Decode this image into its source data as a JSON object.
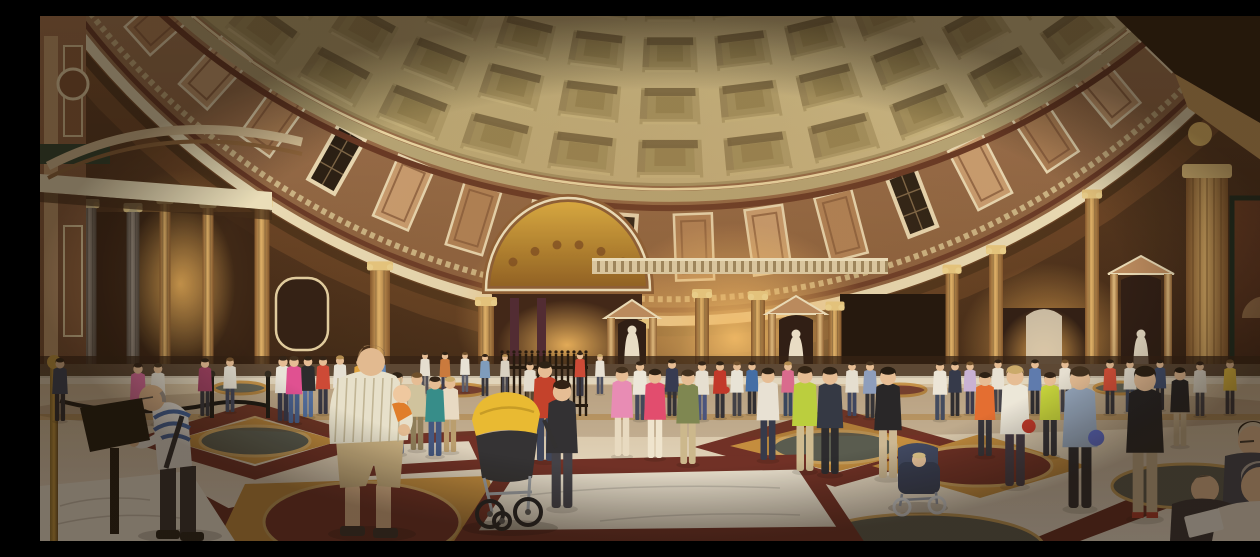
{
  "meta": {
    "title": "Panoramic photograph of the Pantheon interior, Rome",
    "alt": "Wide panoramic photo inside the Pantheon: coffered concrete dome above a curved marble attic and cornice, golden lit chapels, Corinthian columns and statue niches, with crowds of tourists on the patterned marble floor of circles and squares."
  },
  "palette": {
    "wallTop": "#7a4c2a",
    "wallBottom": "#311b0d",
    "dome1": "#a3925e",
    "dome2": "#c8b788",
    "cofferBase": "#a89767",
    "cofferIn1": "#9c8b5b",
    "cofferIn2": "#8f7e4e",
    "cofferShadow": "#695939",
    "cofferHi": "#d9c994",
    "domeRing": "#b3a476",
    "domeRingRed": "#5c2d1e",
    "domeRingHi": "#ead9a8",
    "attic1": "#c79c70",
    "attic2": "#7c5236",
    "panelMarble1": "#c59a70",
    "panelMarble2": "#aa7c54",
    "panelFrame": "#e9dbb8",
    "panelDark": "#19120c",
    "corniceWhite": "#eadfbc",
    "corniceRed": "#5e2f20",
    "corniceShadow": "#33200f",
    "dentil": "#c9b386",
    "colGold1": "#7e5128",
    "colGold2": "#dcae66",
    "colGray1": "#494039",
    "colGray2": "#92877d",
    "aedFace": "#b8875c",
    "statue": "#e9dec9",
    "nicheDark": "#271710",
    "balustrade": "#d9c6a0",
    "baluster": "#8a7048",
    "floorFar": "#cdb795",
    "floorNear": "#efe8da",
    "ochre": "#c28b3c",
    "pRed": "#6b2a22",
    "pRedDark": "#5f241c",
    "slate": "#53574d",
    "marbleWhite": "#e8e0d0",
    "skin": "#e6bd96",
    "shadow": "#2a160a",
    "fence": "#1d120a",
    "rope": "#14110e",
    "brass": "#c79a3e"
  },
  "dome": {
    "cx": 630,
    "cy": -480,
    "rx": 700,
    "ry": 650,
    "sRows": [
      1.0,
      0.918,
      0.838,
      0.76,
      0.684
    ],
    "thetaMax": 56,
    "cols": 15
  },
  "attic": {
    "cx": 630,
    "cy": -470,
    "rx": 760,
    "ry": 775,
    "thetaMax": 60,
    "step": 6.2,
    "pattern": [
      "m1",
      "w",
      "m2",
      "m1",
      "m2",
      "w",
      "m1",
      "m2"
    ]
  },
  "glows": [
    [
      140,
      268,
      85,
      115,
      "#f0b35a",
      0.7
    ],
    [
      530,
      302,
      115,
      95,
      "#f5b95e",
      0.75
    ],
    [
      695,
      322,
      140,
      115,
      "#ffc76d",
      0.95
    ],
    [
      1008,
      332,
      90,
      85,
      "#f0ae54",
      0.8
    ],
    [
      640,
      250,
      540,
      270,
      "#b57a3e",
      0.22
    ]
  ],
  "columns": [
    [
      50,
      13,
      "gray",
      192
    ],
    [
      93,
      13,
      "gray",
      196
    ],
    [
      125,
      11,
      "gold",
      188
    ],
    [
      168,
      11,
      "gold",
      192
    ],
    [
      222,
      15,
      "gold",
      null
    ],
    [
      340,
      20,
      "gold",
      null
    ],
    [
      446,
      16,
      "gold",
      null
    ],
    [
      606,
      13,
      "gold",
      null
    ],
    [
      662,
      14,
      "gold",
      282
    ],
    [
      718,
      14,
      "gold",
      284
    ],
    [
      795,
      13,
      "gold",
      null
    ],
    [
      912,
      13,
      "gold",
      null
    ],
    [
      956,
      14,
      "gold",
      null
    ],
    [
      1052,
      14,
      "gold",
      null
    ]
  ],
  "bigPilaster": [
    1146,
    42,
    162,
    372
  ],
  "aedicules": [
    [
      565,
      54,
      284,
      368
    ],
    [
      726,
      60,
      280,
      372
    ],
    [
      1068,
      66,
      240,
      372
    ]
  ],
  "chapels": {
    "farLeft": [
      40,
      196,
      185,
      156
    ],
    "mosaic": {
      "arch": [
        528,
        274,
        82,
        92
      ],
      "open": [
        452,
        274,
        150,
        92
      ]
    },
    "doorway": [
      800,
      278,
      112,
      92
    ],
    "right": [
      962,
      292,
      84,
      80
    ]
  },
  "fresco": [
    1192,
    182,
    68,
    186
  ],
  "balustradeBand": [
    552,
    242,
    296,
    16
  ],
  "fence": [
    462,
    548,
    338,
    400
  ],
  "floor": {
    "backRow": [
      [
        200,
        372,
        "slate"
      ],
      [
        420,
        374,
        "pRed"
      ],
      [
        640,
        375,
        "slate"
      ],
      [
        860,
        374,
        "pRed"
      ],
      [
        1080,
        372,
        "slate"
      ]
    ],
    "diamonds": [
      [
        215,
        393,
        322,
        425,
        215,
        457,
        108,
        425
      ],
      [
        795,
        398,
        912,
        431,
        795,
        464,
        678,
        431
      ]
    ],
    "stripes": [
      [
        48,
        525,
        318,
        462,
        352,
        470,
        85,
        525
      ],
      [
        132,
        462,
        250,
        525,
        205,
        525,
        108,
        470
      ],
      [
        988,
        525,
        1120,
        470,
        1160,
        480,
        1040,
        525
      ]
    ],
    "medallions": [
      {
        "sq": [
          215,
          402,
          300,
          425,
          215,
          448,
          130,
          425
        ],
        "c": [
          215,
          425,
          55,
          15
        ],
        "k": "slate"
      },
      {
        "sq": [
          795,
          404,
          900,
          430,
          795,
          456,
          690,
          430
        ],
        "c": [
          795,
          431,
          62,
          16
        ],
        "k": "slate"
      },
      {
        "sq": [
          940,
          418,
          1048,
          450,
          940,
          482,
          832,
          450
        ],
        "c": [
          940,
          450,
          72,
          20
        ],
        "k": "pRed"
      },
      {
        "sq": [
          205,
          468,
          448,
          460,
          470,
          525,
          178,
          525
        ],
        "c": [
          322,
          506,
          98,
          40
        ],
        "k": "pRed"
      },
      {
        "sq": null,
        "c": [
          882,
          532,
          122,
          34
        ],
        "k": "slate"
      },
      {
        "sq": null,
        "c": [
          1148,
          470,
          76,
          22
        ],
        "k": "slate"
      }
    ],
    "whiteSquare": [
      470,
      452,
      762,
      446,
      810,
      518,
      425,
      522
    ],
    "redSquare": [
      320,
      425,
      432,
      420,
      445,
      448,
      330,
      455
    ],
    "brightCorner": [
      0,
      470,
      150,
      455,
      195,
      525,
      0,
      525
    ]
  },
  "people": [
    [
      20,
      405,
      60,
      "#2e3a56",
      "#23242b",
      "#241a10"
    ],
    [
      98,
      412,
      62,
      "#d8679c",
      "#31415f",
      "#2a1c12"
    ],
    [
      118,
      408,
      58,
      "#e8e4da",
      "#5a4632",
      "#3a2a1a"
    ],
    [
      165,
      400,
      55,
      "#9c3b62",
      "#2c2c34",
      "#241a10"
    ],
    [
      190,
      396,
      52,
      "#e5e1d6",
      "#3a3f55",
      "#6a4a28"
    ],
    [
      243,
      405,
      62,
      "#e8e5dd",
      "#2e3145",
      "#2a1c12"
    ],
    [
      254,
      407,
      64,
      "#e04b93",
      "#3f5a8c",
      "#3a2a1a"
    ],
    [
      268,
      401,
      58,
      "#23242a",
      "#4a6aa0",
      "#241a10"
    ],
    [
      283,
      398,
      55,
      "#cc4433",
      "#2f3040",
      "#2a1c12"
    ],
    [
      300,
      396,
      54,
      "#e6e2d8",
      "#6b5a3f",
      "#b08a4e"
    ],
    [
      320,
      394,
      50,
      "#e0a23c",
      "#44507a",
      "#241a10"
    ],
    [
      340,
      392,
      50,
      "#5c87c0",
      "#2c2c33",
      "#2a1c12"
    ],
    [
      357,
      438,
      78,
      "#2e3b5e",
      "#3d4f7c",
      "#241a10"
    ],
    [
      377,
      434,
      74,
      "#cfc3a0",
      "#8a7a58",
      "#6a4a28"
    ],
    [
      395,
      440,
      76,
      "#2e8b8b",
      "#3b5280",
      "#2a1c12"
    ],
    [
      410,
      436,
      72,
      "#e8dcc8",
      "#b89c6e",
      "#caa96a"
    ],
    [
      385,
      378,
      40,
      "#e5e0d4",
      "#4a4a55",
      "#3a2a1a"
    ],
    [
      405,
      380,
      42,
      "#c9763a",
      "#33334a",
      "#241a10"
    ],
    [
      425,
      376,
      38,
      "#e8e4da",
      "#55586a",
      "#6a4a28"
    ],
    [
      445,
      380,
      40,
      "#7a9ac0",
      "#2e2e38",
      "#2a1c12"
    ],
    [
      465,
      378,
      38,
      "#d8d2c6",
      "#3c3c48",
      "#b08a4e"
    ],
    [
      490,
      398,
      50,
      "#e3ded2",
      "#51412e",
      "#2a1c12"
    ],
    [
      505,
      445,
      95,
      "#c23b28",
      "#36405a",
      "#241a10"
    ],
    [
      522,
      492,
      122,
      "#2a2a30",
      "#3c3c46",
      "#2a1a10"
    ],
    [
      540,
      380,
      42,
      "#cc4433",
      "#2f3040",
      "#2a1c12"
    ],
    [
      560,
      378,
      38,
      "#e8e3d9",
      "#454a5e",
      "#caa96a"
    ],
    [
      582,
      440,
      85,
      "#e88ab8",
      "#e8dcc4",
      "#3a2a1a"
    ],
    [
      600,
      404,
      56,
      "#ece8de",
      "#3c4258",
      "#2a1c12"
    ],
    [
      615,
      442,
      85,
      "#e2476e",
      "#f0e6d2",
      "#241a10"
    ],
    [
      632,
      400,
      54,
      "#2e3450",
      "#2b2b33",
      "#241a10"
    ],
    [
      648,
      448,
      90,
      "#7a8450",
      "#cbb88e",
      "#3a2a1a"
    ],
    [
      662,
      404,
      56,
      "#e6e1d5",
      "#43507e",
      "#2a1c12"
    ],
    [
      680,
      402,
      54,
      "#c03226",
      "#2c2c34",
      "#241a10",
      null,
      "#c03226"
    ],
    [
      697,
      400,
      52,
      "#e8e5dc",
      "#3a3a44",
      "#6a4a28"
    ],
    [
      712,
      398,
      50,
      "#3c6aa8",
      "#26262e",
      "#2a1c12"
    ],
    [
      728,
      444,
      88,
      "#e8e3d8",
      "#2e3348",
      "#241a10"
    ],
    [
      748,
      400,
      52,
      "#d8678f",
      "#31415c",
      "#b08a4e"
    ],
    [
      765,
      455,
      100,
      "#b9cf3b",
      "#cdbb92",
      "#2a1c10"
    ],
    [
      790,
      458,
      102,
      "#2c3242",
      "#23242b",
      "#241a10"
    ],
    [
      812,
      400,
      52,
      "#e5e0d4",
      "#36405e",
      "#2a1c12"
    ],
    [
      830,
      402,
      54,
      "#8a9cc0",
      "#2c2c33",
      "#3a2a1a"
    ],
    [
      848,
      462,
      106,
      "#1f1f24",
      "#cbb794",
      "#1c140c"
    ],
    [
      900,
      404,
      56,
      "#ece7dc",
      "#3b465e",
      "#2a1c12"
    ],
    [
      915,
      400,
      52,
      "#2d3348",
      "#26262d",
      "#241a10"
    ],
    [
      930,
      398,
      50,
      "#c8b2d8",
      "#33334a",
      "#6a4a28"
    ],
    [
      945,
      440,
      80,
      "#e46a2e",
      "#2e2e38",
      "#241a10"
    ],
    [
      958,
      396,
      50,
      "#e8e3d7",
      "#3c3c46",
      "#2a1c12"
    ],
    [
      975,
      470,
      115,
      "#ede9de",
      "#3c3442",
      "#caa96a",
      null,
      "#c03226"
    ],
    [
      995,
      398,
      52,
      "#5878b0",
      "#26262e",
      "#241a10"
    ],
    [
      1010,
      440,
      80,
      "#c4d438",
      "#2c2c34",
      "#2a1c12"
    ],
    [
      1025,
      396,
      50,
      "#e6e1d5",
      "#3a3a44",
      "#6a4a28"
    ],
    [
      1040,
      492,
      135,
      "#93a7c2",
      "#23242b",
      "#3a2a1a",
      null,
      "#5566c9"
    ],
    [
      1070,
      398,
      52,
      "#d84b36",
      "#2d2d36",
      "#241a10"
    ],
    [
      1090,
      396,
      50,
      "#e9e4d8",
      "#374058",
      "#2a1c12"
    ],
    [
      1105,
      502,
      145,
      "#1d1d22",
      "#cdb794",
      "#241a10",
      "#b03226",
      null
    ],
    [
      1120,
      394,
      48,
      "#3a4a70",
      "#26262e",
      "#241a10"
    ],
    [
      1140,
      430,
      75,
      "#1d1d22",
      "#cbb794",
      "#1c140c"
    ],
    [
      1160,
      400,
      52,
      "#e6e1d5",
      "#3b3b45",
      "#2a1c12"
    ],
    [
      1190,
      398,
      52,
      "#e8c23e",
      "#2f2f3a",
      "#6a4a28"
    ],
    [
      1244,
      418,
      68,
      "#2e3c5c",
      "#26262e",
      "#241a10"
    ]
  ]
}
